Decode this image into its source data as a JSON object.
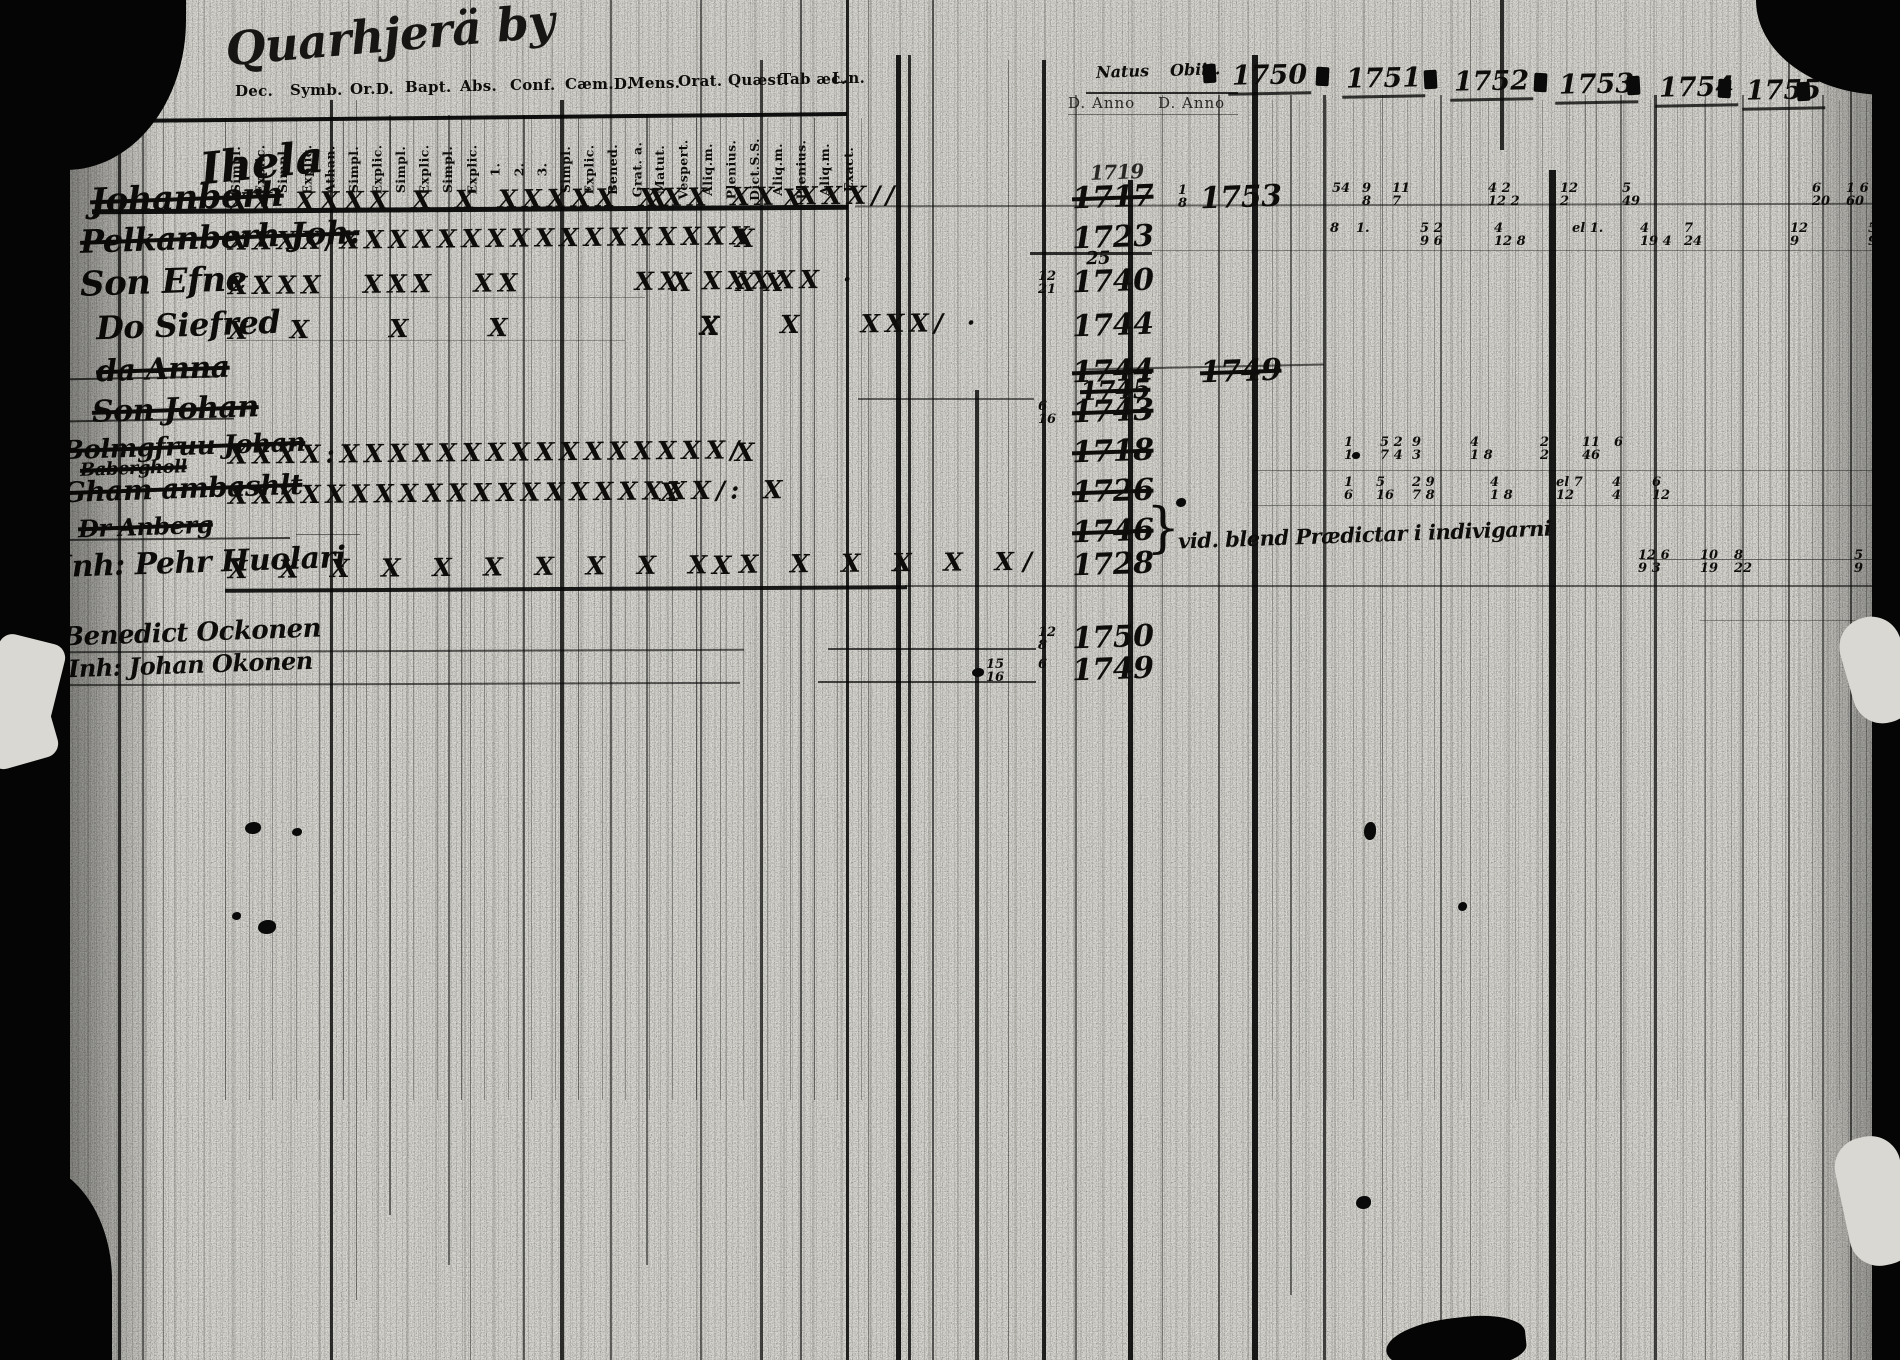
{
  "document": {
    "title_script": "Quarhjerä by",
    "left_table": {
      "heading_script": "Ihela",
      "group_headers": [
        "Dec.",
        "Symb.",
        "Or.D.",
        "Bapt.",
        "Abs.",
        "Conf.",
        "Cæm.D.",
        "Mens.",
        "Orat.",
        "Quæst.",
        "Tab æc.",
        "L.n."
      ],
      "sub_headers": [
        "Simpl.",
        "Explic.",
        "Simpl.",
        "Explic.",
        "Athan.",
        "Simpl.",
        "Explic.",
        "Simpl.",
        "Explic.",
        "Simpl.",
        "Explic.",
        "1.",
        "2.",
        "3.",
        "Simpl.",
        "Explic.",
        "Bened.",
        "Grat. a.",
        "Matut.",
        "Vespert.",
        "Aliq.m.",
        "Plenius.",
        "Dict.S.S.",
        "Aliq.m.",
        "Plenius.",
        "Aliq.m.",
        "Exact."
      ]
    },
    "right_table": {
      "natus_label": "Natus",
      "obiit_label": "Obiit.",
      "anno_label_1": "D. Anno",
      "anno_label_2": "D. Anno",
      "years": [
        "1750",
        "1751",
        "1752",
        "1753",
        "1754",
        "1755"
      ]
    },
    "rows": [
      {
        "name": "Johanberh",
        "struck": true,
        "marks": "XX XXXX X X XXXXX XXX XX XXX//",
        "tail": "X      X",
        "natus": "1717",
        "natus_ghost": "1719",
        "natus_struck": true,
        "obiit_pre_t": "1",
        "obiit_pre_b": "8",
        "obiit": "1753",
        "year_notes": [
          {
            "x": 1332,
            "t": "54",
            "b": ""
          },
          {
            "x": 1362,
            "t": "9",
            "b": "8"
          },
          {
            "x": 1392,
            "t": "11",
            "b": "7"
          },
          {
            "x": 1488,
            "t": "4 2",
            "b": "12 2"
          },
          {
            "x": 1560,
            "t": "12",
            "b": "2"
          },
          {
            "x": 1622,
            "t": "5",
            "b": "49"
          },
          {
            "x": 1812,
            "t": "6",
            "b": "20"
          },
          {
            "x": 1846,
            "t": "1 6",
            "b": "60"
          }
        ]
      },
      {
        "name": "Pelkanberh Joh.",
        "struck": true,
        "marks": "XXXX/XXXXXXXXXXXXXXXXX",
        "tail": "X",
        "natus": "1723",
        "natus_sub": "25",
        "year_notes": [
          {
            "x": 1330,
            "t": "8",
            "b": ""
          },
          {
            "x": 1356,
            "t": "1.",
            "b": ""
          },
          {
            "x": 1420,
            "t": "5 2",
            "b": "9 6"
          },
          {
            "x": 1494,
            "t": "4",
            "b": "12 8"
          },
          {
            "x": 1572,
            "t": "el 1.",
            "b": ""
          },
          {
            "x": 1640,
            "t": "4",
            "b": "19 4"
          },
          {
            "x": 1684,
            "t": "7",
            "b": "24"
          },
          {
            "x": 1790,
            "t": "12",
            "b": "9"
          },
          {
            "x": 1868,
            "t": "5",
            "b": "9"
          }
        ]
      },
      {
        "name": "Son Efne",
        "struck": false,
        "marks": "XXXX  XXX  XX      XX XXXXX ·",
        "tail": "X  XX",
        "natus_pre_t": "12",
        "natus_pre_b": "21",
        "natus": "1740",
        "year_notes": []
      },
      {
        "name": "Do Siefred",
        "struck": false,
        "marks": "X  X    X    X          X   X   XXX/ ·",
        "tail": "X",
        "natus": "1744",
        "year_notes": []
      },
      {
        "name": "da Anna",
        "struck": true,
        "marks": "",
        "tail": "",
        "natus": "1744",
        "natus2": "1745",
        "natus_struck": true,
        "obiit": "1749",
        "obiit_struck": true,
        "year_notes": []
      },
      {
        "name": "Son Johan",
        "struck": true,
        "marks": "",
        "tail": "",
        "natus_pre_t": "6",
        "natus_pre_b": "16",
        "natus": "1743",
        "natus_struck": true,
        "year_notes": []
      },
      {
        "name": "Bolmgfruu Johan",
        "name2": "Babergholl",
        "struck": true,
        "marks": "XXXX:XXXXXXXXXXXXXXXX/",
        "tail": "X",
        "natus": "1718",
        "natus_struck": true,
        "year_notes": [
          {
            "x": 1344,
            "t": "1",
            "b": "1"
          },
          {
            "x": 1380,
            "t": "5 2",
            "b": "7 4"
          },
          {
            "x": 1412,
            "t": "9",
            "b": "3"
          },
          {
            "x": 1470,
            "t": "4",
            "b": "1 8"
          },
          {
            "x": 1540,
            "t": "2",
            "b": "2"
          },
          {
            "x": 1582,
            "t": "11",
            "b": "46"
          },
          {
            "x": 1614,
            "t": "6",
            "b": ""
          }
        ]
      },
      {
        "name": "Gham ambashlt",
        "struck": true,
        "marks": "XXXXXXXXXXXXXXXXXXXX/: X",
        "tail": "X",
        "natus": "1726",
        "natus_struck": true,
        "year_notes": [
          {
            "x": 1344,
            "t": "1",
            "b": "6"
          },
          {
            "x": 1376,
            "t": "5",
            "b": "16"
          },
          {
            "x": 1412,
            "t": "2 9",
            "b": "7 8"
          },
          {
            "x": 1490,
            "t": "4",
            "b": "1 8"
          },
          {
            "x": 1556,
            "t": "el 7",
            "b": "12"
          },
          {
            "x": 1612,
            "t": "4",
            "b": "4"
          },
          {
            "x": 1652,
            "t": "6",
            "b": "12"
          }
        ]
      },
      {
        "name": "Dr Anberg",
        "struck": true,
        "marks": "",
        "tail": "",
        "natus": "1746",
        "natus_struck": true,
        "note_brace": "}",
        "note": "vid. blend Prædictar i indivigarni",
        "year_notes": []
      },
      {
        "name": "Inh: Pehr Huolari",
        "struck": false,
        "marks": "X X X X X X X X X X X X X X X X/",
        "tail": "X",
        "natus": "1728",
        "year_notes": [
          {
            "x": 1638,
            "t": "12 6",
            "b": "9 3"
          },
          {
            "x": 1700,
            "t": "10",
            "b": "19"
          },
          {
            "x": 1734,
            "t": "8",
            "b": "22"
          },
          {
            "x": 1854,
            "t": "5",
            "b": "9"
          }
        ]
      },
      {
        "name": "Benedict Ockonen",
        "struck": false,
        "marks": "",
        "tail": "",
        "natus_pre_t": "12",
        "natus_pre_b": "8",
        "natus": "1750",
        "year_notes": []
      },
      {
        "name": "Inh: Johan Okonen",
        "struck": false,
        "marks": "",
        "tail": "",
        "natus_left_t": "15",
        "natus_left_b": "16",
        "natus_pre_t": "6",
        "natus_pre_b": "",
        "natus": "1749",
        "year_notes": []
      }
    ]
  }
}
